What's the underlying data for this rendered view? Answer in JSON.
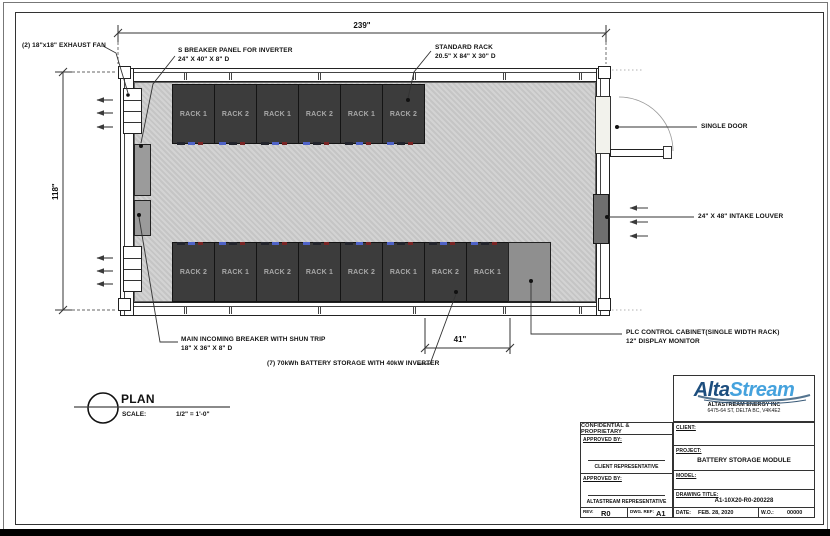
{
  "plan": {
    "dimensions": {
      "width": "239\"",
      "height": "118\"",
      "rack_pair": "41\""
    },
    "annotations": {
      "exhaust_fan": "(2) 18\"x18\" EXHAUST FAN",
      "breaker_panel_line1": "S BREAKER PANEL FOR INVERTER",
      "breaker_panel_line2": "24\" X 40\" X 8\" D",
      "standard_rack_line1": "STANDARD RACK",
      "standard_rack_line2": "20.5\" X 84\" X 30\" D",
      "single_door": "SINGLE DOOR",
      "intake_louver": "24\" X 48\" INTAKE LOUVER",
      "main_breaker_line1": "MAIN INCOMING BREAKER WITH SHUN TRIP",
      "main_breaker_line2": "18\" X 36\" X 8\" D",
      "battery_storage": "(7) 70kWh BATTERY STORAGE WITH 40kW INVERTER",
      "plc_line1": "PLC CONTROL CABINET(SINGLE WIDTH RACK)",
      "plc_line2": "12\" DISPLAY MONITOR"
    },
    "racks_top": [
      "RACK 1",
      "RACK 2",
      "RACK 1",
      "RACK 2",
      "RACK 1",
      "RACK 2"
    ],
    "racks_bottom": [
      "RACK 2",
      "RACK 1",
      "RACK 2",
      "RACK 1",
      "RACK 2",
      "RACK 1",
      "RACK 2",
      "RACK 1"
    ],
    "view": {
      "label": "PLAN",
      "scale_label": "SCALE:",
      "scale_value": "1/2\" = 1'-0\""
    }
  },
  "title_block": {
    "logo_alta": "Alta",
    "logo_stream": "Stream",
    "company": "ALTASTREAM ENERGY INC",
    "address": "6475-64 ST, DELTA BC, V4K4E2",
    "confidential": "CONFIDENTIAL & PROPRIETARY",
    "approved_by_1": "APPROVED BY:",
    "approved_by_2": "APPROVED BY:",
    "client_rep": "CLIENT REPRESENTATIVE",
    "alta_rep": "ALTASTREAM REPRESENTATIVE",
    "client_label": "CLIENT:",
    "project_label": "PROJECT:",
    "project_value": "BATTERY STORAGE MODULE",
    "model_label": "MODEL:",
    "drawing_title_label": "DRAWING TITLE:",
    "drawing_title_value": "A1-10X20-R0-200228",
    "rev_label": "REV:",
    "rev_value": "R0",
    "dwg_label": "DWG. REF:",
    "dwg_value": "A1",
    "date_label": "DATE:",
    "date_value": "FEB. 28, 2020",
    "wo_label": "W.O.:",
    "wo_value": "00000"
  },
  "colors": {
    "logo_dark_blue": "#1d4e7e",
    "logo_light_blue": "#45a2dd",
    "rack_fill": "#3c3c3c",
    "hatch_gray": "#cccccc",
    "line": "#222222"
  },
  "icons": {
    "airflow_arrow": "←",
    "leader_dot": "●"
  }
}
